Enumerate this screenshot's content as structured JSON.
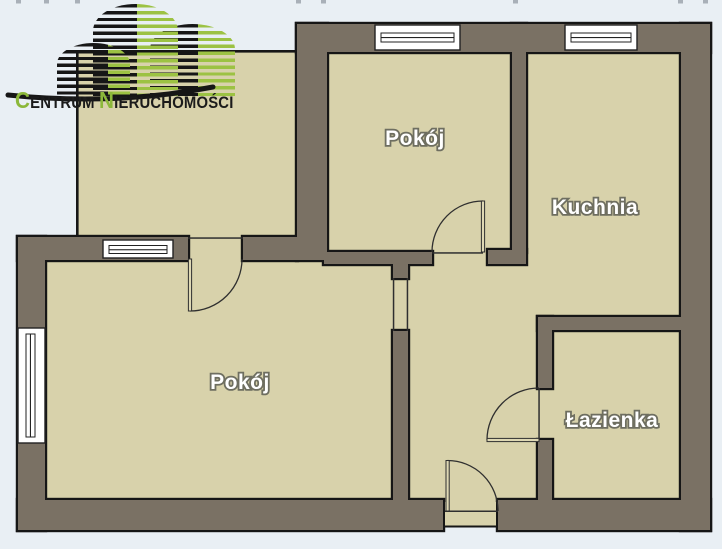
{
  "logo": {
    "brand_part1_initial": "C",
    "brand_part1_rest": "ENTRUM",
    "brand_part2_initial": "N",
    "brand_part2_rest": "IERUCHOMOŚCI"
  },
  "rooms": {
    "pokoj_top": "Pokój",
    "kuchnia": "Kuchnia",
    "pokoj_main": "Pokój",
    "lazienka": "Łazienka"
  },
  "colors": {
    "background": "#e9eff4",
    "floor": "#d8d2ab",
    "wall_fill": "#7a7164",
    "wall_outline": "#161616",
    "window_fill": "#ffffff",
    "door_line": "#2f2f2f",
    "label_text": "#ffffff",
    "label_outline": "#6e6e60",
    "logo_green": "#9cc243",
    "logo_black": "#161616",
    "upper_floor_tick": "#a9b0b8"
  }
}
